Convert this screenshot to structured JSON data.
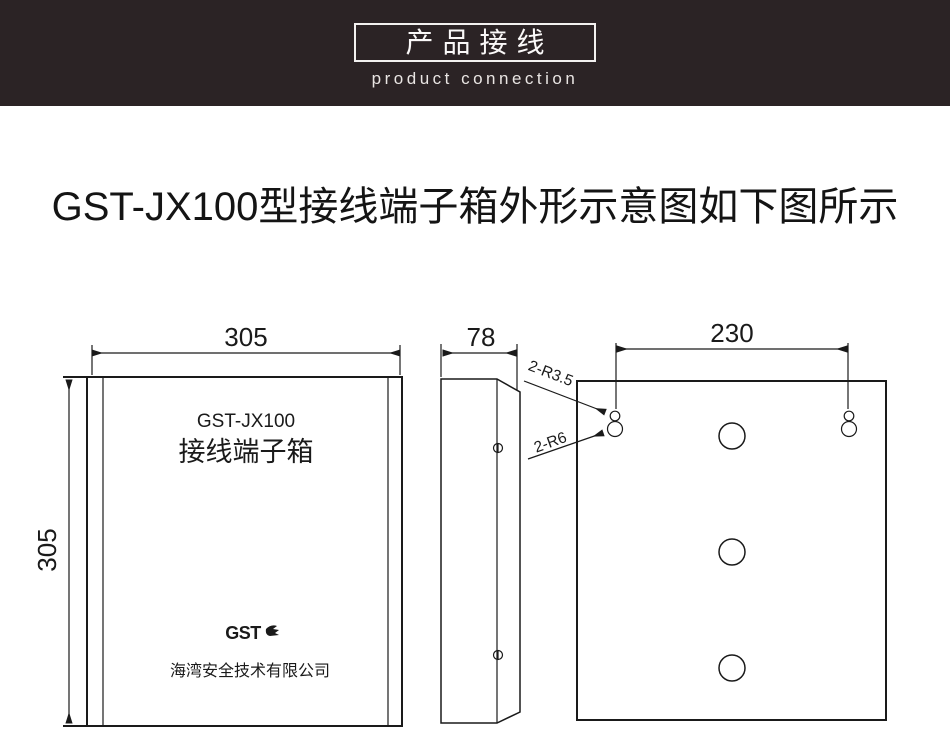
{
  "header": {
    "title_cn": "产品接线",
    "subtitle_en": "product connection",
    "bg_color": "#2b2325",
    "text_color": "#faf8f8"
  },
  "page": {
    "heading": "GST-JX100型接线端子箱外形示意图如下图所示",
    "bg_color": "#ffffff",
    "line_color": "#1a1a1a"
  },
  "drawing": {
    "front_view": {
      "width_dim": "305",
      "height_dim": "305",
      "model": "GST-JX100",
      "product_name": "接线端子箱",
      "logo_text": "GST",
      "company": "海湾安全技术有限公司"
    },
    "side_view": {
      "depth_dim": "78"
    },
    "back_view": {
      "hole_spacing_dim": "230",
      "small_keyhole_label": "2-R3.5",
      "large_keyhole_label": "2-R6"
    }
  }
}
